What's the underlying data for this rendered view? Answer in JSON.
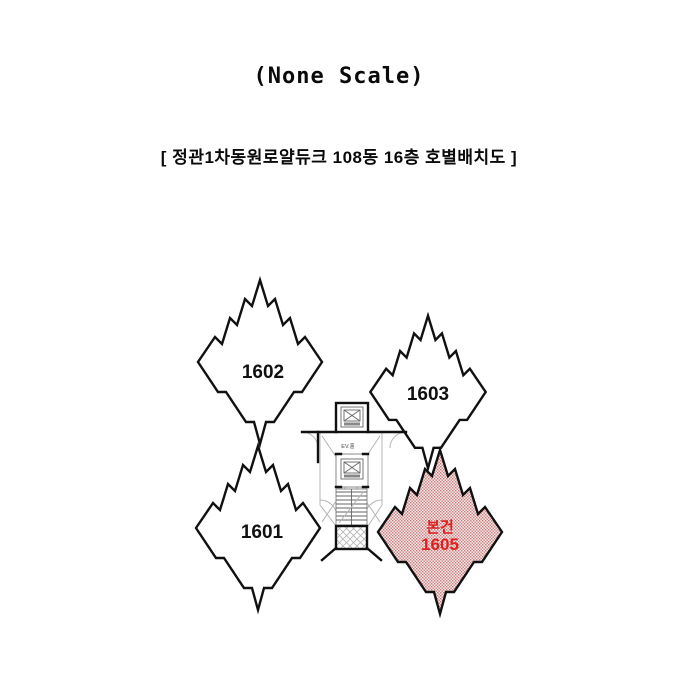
{
  "header": {
    "scale_note": "(None Scale)",
    "title": "[ 정관1차동원로얄듀크 108동 16층 호별배치도 ]"
  },
  "floor_plan": {
    "units": [
      {
        "label": "1602",
        "position": "top-left",
        "highlighted": false
      },
      {
        "label": "1603",
        "position": "top-right",
        "highlighted": false
      },
      {
        "label": "1601",
        "position": "bottom-left",
        "highlighted": false
      },
      {
        "label": "1605",
        "position": "bottom-right",
        "highlighted": true,
        "highlight_label": "본건"
      }
    ],
    "core": {
      "elevator_hall_label": "EV.홀",
      "icons": [
        "elevator-icon",
        "elevator-icon",
        "stairs-icon",
        "shaft-hatch-icon"
      ]
    },
    "colors": {
      "outline": "#111111",
      "highlight_fill": "#f6e9e9",
      "highlight_dot": "#c97b7b",
      "highlight_text": "#de2020"
    }
  }
}
